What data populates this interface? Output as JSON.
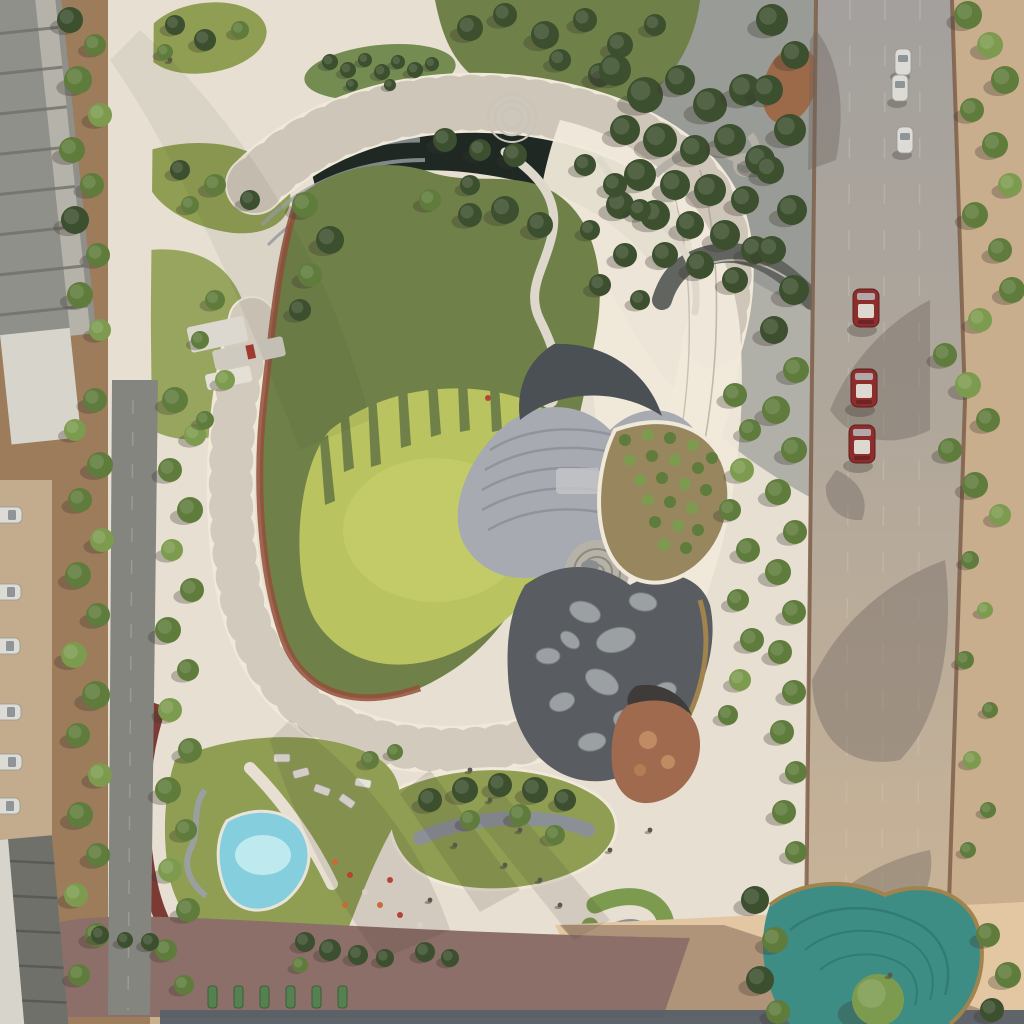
{
  "meta": {
    "description": "Aerial drone view of a landscaped urban park with a spiral elevated walkway, central kidney-shaped lawn, terraced amphitheater, boulder pond, orchard grove, swimming pool, teal contour pond, apartment roofs on the left and a road with red and white cars on the right",
    "width": 1024,
    "height": 1024
  },
  "palette": {
    "sand": "#c9ae8e",
    "sandLight": "#e3c7a2",
    "sandShadow": "#a2876f",
    "soil": "#9c7c5a",
    "soilDark": "#85684a",
    "plaza": "#e7e0d2",
    "plazaBright": "#f0e9da",
    "plazaShade": "#b2b1ad",
    "roadAsphalt": "#85857f",
    "roadRightTop": "#a3a09d",
    "roadRightLow": "#c9b396",
    "mauveRoad": "#8c6f68",
    "bottomRoad": "#596067",
    "lawnBright": "#b9c360",
    "lawnLight": "#ccd36e",
    "lawnOlive": "#6f8048",
    "lawnMid": "#8f9e52",
    "treeDark": "#3c4f2e",
    "treeMid": "#5f7c3c",
    "treeLight": "#7d9b4e",
    "treeYellow": "#9bae59",
    "canyon": "#1f2823",
    "terraceGray": "#9aa0a4",
    "amphiLight": "#a7abb1",
    "amphiMid": "#8b9097",
    "amphiDark": "#4a5054",
    "pondDark": "#595d61",
    "boulder": "#9ba0a3",
    "poolBlue": "#85cede",
    "poolLightBlue": "#c8edf2",
    "tealPond": "#3d8d85",
    "tealPondDark": "#2e746d",
    "pondRim": "#a0834d",
    "trackRust": "#94503c",
    "trackRed": "#7c3a35",
    "carRed": "#8e2e2c",
    "carRoofWhite": "#ddd8d0",
    "carWhite": "#dcdbd6",
    "carGlass": "#8f9499",
    "buildingGray": "#90908a",
    "buildingDark": "#70706b",
    "buildingWhite": "#d7d4cb",
    "curb": "#7b5a44",
    "playground": "#a06a4e",
    "playgroundDark": "#3f3b38",
    "shadow": "#3a352e",
    "shadeOverlay": "#31404a"
  },
  "scene": {
    "trees": [
      [
        70,
        20,
        13,
        "d"
      ],
      [
        95,
        45,
        11,
        "m"
      ],
      [
        78,
        80,
        14,
        "m"
      ],
      [
        100,
        115,
        12,
        "l"
      ],
      [
        72,
        150,
        13,
        "m"
      ],
      [
        92,
        185,
        12,
        "m"
      ],
      [
        75,
        220,
        14,
        "d"
      ],
      [
        98,
        255,
        12,
        "m"
      ],
      [
        80,
        295,
        13,
        "m"
      ],
      [
        100,
        330,
        11,
        "l"
      ],
      [
        95,
        400,
        12,
        "m"
      ],
      [
        75,
        430,
        11,
        "l"
      ],
      [
        100,
        465,
        13,
        "m"
      ],
      [
        80,
        500,
        12,
        "m"
      ],
      [
        102,
        540,
        12,
        "l"
      ],
      [
        78,
        575,
        13,
        "m"
      ],
      [
        98,
        615,
        12,
        "m"
      ],
      [
        74,
        655,
        13,
        "l"
      ],
      [
        96,
        695,
        14,
        "m"
      ],
      [
        78,
        735,
        12,
        "m"
      ],
      [
        100,
        775,
        12,
        "l"
      ],
      [
        80,
        815,
        13,
        "m"
      ],
      [
        98,
        855,
        12,
        "m"
      ],
      [
        76,
        895,
        12,
        "l"
      ],
      [
        97,
        935,
        12,
        "m"
      ],
      [
        79,
        975,
        11,
        "m"
      ],
      [
        175,
        400,
        13,
        "m"
      ],
      [
        195,
        435,
        11,
        "l"
      ],
      [
        170,
        470,
        12,
        "m"
      ],
      [
        190,
        510,
        13,
        "m"
      ],
      [
        172,
        550,
        11,
        "l"
      ],
      [
        192,
        590,
        12,
        "m"
      ],
      [
        168,
        630,
        13,
        "m"
      ],
      [
        188,
        670,
        11,
        "m"
      ],
      [
        170,
        710,
        12,
        "l"
      ],
      [
        190,
        750,
        12,
        "m"
      ],
      [
        168,
        790,
        13,
        "m"
      ],
      [
        186,
        830,
        11,
        "m"
      ],
      [
        170,
        870,
        12,
        "l"
      ],
      [
        188,
        910,
        12,
        "m"
      ],
      [
        166,
        950,
        11,
        "m"
      ],
      [
        184,
        985,
        10,
        "m"
      ],
      [
        175,
        25,
        10,
        "d"
      ],
      [
        205,
        40,
        11,
        "d"
      ],
      [
        240,
        30,
        9,
        "m"
      ],
      [
        165,
        52,
        8,
        "m"
      ],
      [
        180,
        170,
        10,
        "d"
      ],
      [
        215,
        185,
        11,
        "m"
      ],
      [
        250,
        200,
        10,
        "d"
      ],
      [
        190,
        205,
        9,
        "m"
      ],
      [
        330,
        62,
        8,
        "d"
      ],
      [
        348,
        70,
        8,
        "d"
      ],
      [
        365,
        60,
        7,
        "d"
      ],
      [
        382,
        72,
        8,
        "d"
      ],
      [
        398,
        62,
        7,
        "d"
      ],
      [
        415,
        70,
        8,
        "d"
      ],
      [
        432,
        64,
        7,
        "d"
      ],
      [
        352,
        85,
        6,
        "d"
      ],
      [
        390,
        85,
        6,
        "d"
      ],
      [
        470,
        28,
        13,
        "d"
      ],
      [
        505,
        15,
        12,
        "d"
      ],
      [
        545,
        35,
        14,
        "d"
      ],
      [
        585,
        20,
        12,
        "d"
      ],
      [
        620,
        45,
        13,
        "d"
      ],
      [
        655,
        25,
        11,
        "d"
      ],
      [
        600,
        75,
        12,
        "d"
      ],
      [
        560,
        60,
        11,
        "d"
      ],
      [
        615,
        70,
        16,
        "d"
      ],
      [
        645,
        95,
        18,
        "d"
      ],
      [
        680,
        80,
        15,
        "d"
      ],
      [
        710,
        105,
        17,
        "d"
      ],
      [
        745,
        90,
        16,
        "d"
      ],
      [
        625,
        130,
        15,
        "d"
      ],
      [
        660,
        140,
        17,
        "d"
      ],
      [
        695,
        150,
        15,
        "d"
      ],
      [
        730,
        140,
        16,
        "d"
      ],
      [
        760,
        160,
        15,
        "d"
      ],
      [
        640,
        175,
        16,
        "d"
      ],
      [
        675,
        185,
        15,
        "d"
      ],
      [
        710,
        190,
        16,
        "d"
      ],
      [
        745,
        200,
        14,
        "d"
      ],
      [
        620,
        205,
        14,
        "d"
      ],
      [
        655,
        215,
        15,
        "d"
      ],
      [
        690,
        225,
        14,
        "d"
      ],
      [
        725,
        235,
        15,
        "d"
      ],
      [
        755,
        250,
        14,
        "d"
      ],
      [
        700,
        265,
        14,
        "d"
      ],
      [
        665,
        255,
        13,
        "d"
      ],
      [
        735,
        280,
        13,
        "d"
      ],
      [
        305,
        205,
        13,
        "m"
      ],
      [
        330,
        240,
        14,
        "d"
      ],
      [
        310,
        275,
        12,
        "m"
      ],
      [
        300,
        310,
        11,
        "d"
      ],
      [
        445,
        140,
        12,
        "d"
      ],
      [
        480,
        150,
        11,
        "d"
      ],
      [
        515,
        155,
        12,
        "d"
      ],
      [
        470,
        185,
        10,
        "d"
      ],
      [
        430,
        200,
        11,
        "m"
      ],
      [
        585,
        165,
        11,
        "d"
      ],
      [
        615,
        185,
        12,
        "d"
      ],
      [
        640,
        210,
        11,
        "d"
      ],
      [
        590,
        230,
        10,
        "d"
      ],
      [
        625,
        255,
        12,
        "d"
      ],
      [
        600,
        285,
        11,
        "d"
      ],
      [
        640,
        300,
        10,
        "d"
      ],
      [
        505,
        210,
        14,
        "d"
      ],
      [
        540,
        225,
        13,
        "d"
      ],
      [
        470,
        215,
        12,
        "d"
      ],
      [
        215,
        300,
        10,
        "m"
      ],
      [
        200,
        340,
        9,
        "m"
      ],
      [
        225,
        380,
        10,
        "l"
      ],
      [
        205,
        420,
        9,
        "m"
      ],
      [
        735,
        395,
        12,
        "m"
      ],
      [
        750,
        430,
        11,
        "m"
      ],
      [
        742,
        470,
        12,
        "l"
      ],
      [
        730,
        510,
        11,
        "m"
      ],
      [
        748,
        550,
        12,
        "m"
      ],
      [
        738,
        600,
        11,
        "m"
      ],
      [
        752,
        640,
        12,
        "m"
      ],
      [
        740,
        680,
        11,
        "l"
      ],
      [
        728,
        715,
        10,
        "m"
      ],
      [
        772,
        20,
        16,
        "d"
      ],
      [
        795,
        55,
        14,
        "d"
      ],
      [
        768,
        90,
        15,
        "d"
      ],
      [
        790,
        130,
        16,
        "d"
      ],
      [
        770,
        170,
        14,
        "d"
      ],
      [
        792,
        210,
        15,
        "d"
      ],
      [
        772,
        250,
        14,
        "d"
      ],
      [
        794,
        290,
        15,
        "d"
      ],
      [
        774,
        330,
        14,
        "d"
      ],
      [
        796,
        370,
        13,
        "m"
      ],
      [
        776,
        410,
        14,
        "m"
      ],
      [
        794,
        450,
        13,
        "m"
      ],
      [
        778,
        492,
        13,
        "m"
      ],
      [
        795,
        532,
        12,
        "m"
      ],
      [
        778,
        572,
        13,
        "m"
      ],
      [
        794,
        612,
        12,
        "m"
      ],
      [
        780,
        652,
        12,
        "m"
      ],
      [
        794,
        692,
        12,
        "m"
      ],
      [
        782,
        732,
        12,
        "m"
      ],
      [
        796,
        772,
        11,
        "m"
      ],
      [
        784,
        812,
        12,
        "m"
      ],
      [
        796,
        852,
        11,
        "m"
      ],
      [
        968,
        15,
        14,
        "m"
      ],
      [
        990,
        45,
        13,
        "l"
      ],
      [
        1005,
        80,
        14,
        "m"
      ],
      [
        972,
        110,
        12,
        "m"
      ],
      [
        995,
        145,
        13,
        "m"
      ],
      [
        1010,
        185,
        12,
        "l"
      ],
      [
        975,
        215,
        13,
        "m"
      ],
      [
        1000,
        250,
        12,
        "m"
      ],
      [
        1012,
        290,
        13,
        "m"
      ],
      [
        980,
        320,
        12,
        "l"
      ],
      [
        945,
        355,
        12,
        "m"
      ],
      [
        968,
        385,
        13,
        "l"
      ],
      [
        988,
        420,
        12,
        "m"
      ],
      [
        950,
        450,
        12,
        "m"
      ],
      [
        975,
        485,
        13,
        "m"
      ],
      [
        1000,
        515,
        11,
        "l"
      ],
      [
        970,
        560,
        9,
        "m"
      ],
      [
        985,
        610,
        8,
        "l"
      ],
      [
        965,
        660,
        9,
        "m"
      ],
      [
        990,
        710,
        8,
        "m"
      ],
      [
        972,
        760,
        9,
        "l"
      ],
      [
        988,
        810,
        8,
        "m"
      ],
      [
        968,
        850,
        8,
        "m"
      ],
      [
        755,
        900,
        14,
        "d"
      ],
      [
        775,
        940,
        13,
        "m"
      ],
      [
        760,
        980,
        14,
        "d"
      ],
      [
        778,
        1012,
        12,
        "m"
      ],
      [
        988,
        935,
        12,
        "m"
      ],
      [
        1008,
        975,
        13,
        "m"
      ],
      [
        992,
        1010,
        12,
        "d"
      ],
      [
        878,
        1000,
        26,
        "l"
      ],
      [
        430,
        800,
        12,
        "d"
      ],
      [
        465,
        790,
        13,
        "d"
      ],
      [
        500,
        785,
        12,
        "d"
      ],
      [
        535,
        790,
        13,
        "d"
      ],
      [
        565,
        800,
        11,
        "d"
      ],
      [
        470,
        820,
        10,
        "m"
      ],
      [
        520,
        815,
        11,
        "m"
      ],
      [
        555,
        835,
        10,
        "m"
      ],
      [
        370,
        760,
        9,
        "m"
      ],
      [
        395,
        752,
        8,
        "m"
      ],
      [
        305,
        942,
        10,
        "d"
      ],
      [
        330,
        950,
        11,
        "d"
      ],
      [
        358,
        955,
        10,
        "d"
      ],
      [
        385,
        958,
        9,
        "d"
      ],
      [
        300,
        965,
        8,
        "m"
      ],
      [
        100,
        935,
        9,
        "d"
      ],
      [
        125,
        940,
        8,
        "d"
      ],
      [
        150,
        942,
        9,
        "d"
      ],
      [
        425,
        952,
        10,
        "d"
      ],
      [
        450,
        958,
        9,
        "d"
      ]
    ],
    "orchard": [
      [
        625,
        440
      ],
      [
        648,
        435
      ],
      [
        670,
        438
      ],
      [
        693,
        445
      ],
      [
        712,
        458
      ],
      [
        630,
        460
      ],
      [
        652,
        456
      ],
      [
        675,
        460
      ],
      [
        698,
        468
      ],
      [
        640,
        480
      ],
      [
        662,
        478
      ],
      [
        685,
        484
      ],
      [
        706,
        490
      ],
      [
        648,
        500
      ],
      [
        670,
        502
      ],
      [
        692,
        508
      ],
      [
        655,
        522
      ],
      [
        678,
        526
      ],
      [
        698,
        530
      ],
      [
        664,
        545
      ],
      [
        686,
        548
      ]
    ],
    "boulders": [
      [
        585,
        612,
        16,
        10,
        20
      ],
      [
        616,
        640,
        20,
        12,
        -15
      ],
      [
        643,
        602,
        14,
        9,
        10
      ],
      [
        602,
        682,
        18,
        11,
        30
      ],
      [
        562,
        702,
        13,
        9,
        -20
      ],
      [
        632,
        722,
        19,
        12,
        15
      ],
      [
        592,
        742,
        14,
        9,
        -10
      ],
      [
        650,
        762,
        17,
        11,
        25
      ],
      [
        548,
        656,
        12,
        8,
        0
      ],
      [
        664,
        692,
        13,
        9,
        -25
      ],
      [
        570,
        640,
        11,
        7,
        40
      ]
    ],
    "cars": {
      "red": [
        [
          866,
          308
        ],
        [
          864,
          388
        ],
        [
          862,
          444
        ]
      ],
      "white_top": [
        [
          903,
          62
        ],
        [
          900,
          88
        ],
        [
          905,
          140
        ]
      ],
      "white_bottom": [
        [
          936,
          992
        ]
      ],
      "parked_left": [
        [
          6,
          515
        ],
        [
          5,
          592
        ],
        [
          4,
          646
        ],
        [
          5,
          712
        ],
        [
          6,
          762
        ],
        [
          4,
          806
        ]
      ]
    },
    "parking_dashes": {
      "x0": 208,
      "y": 986,
      "step": 26,
      "w": 9,
      "h": 22,
      "count": 6
    },
    "people": [
      [
        470,
        770
      ],
      [
        490,
        800
      ],
      [
        520,
        830
      ],
      [
        455,
        845
      ],
      [
        505,
        865
      ],
      [
        540,
        880
      ],
      [
        430,
        900
      ],
      [
        560,
        905
      ],
      [
        610,
        850
      ],
      [
        650,
        830
      ],
      [
        170,
        60
      ],
      [
        890,
        975
      ]
    ],
    "flowers": [
      [
        335,
        862,
        "#c96a3a"
      ],
      [
        350,
        875,
        "#b54434"
      ],
      [
        365,
        892,
        "#d8d2c4"
      ],
      [
        380,
        905,
        "#c96a3a"
      ],
      [
        400,
        915,
        "#b54434"
      ],
      [
        420,
        925,
        "#d8d2c4"
      ],
      [
        345,
        905,
        "#c96a3a"
      ],
      [
        390,
        880,
        "#b54434"
      ],
      [
        488,
        398,
        "#b54434"
      ]
    ],
    "loungers": [
      [
        322,
        790,
        20
      ],
      [
        347,
        801,
        35
      ],
      [
        363,
        783,
        10
      ],
      [
        301,
        773,
        -15
      ],
      [
        282,
        758,
        0
      ]
    ]
  }
}
